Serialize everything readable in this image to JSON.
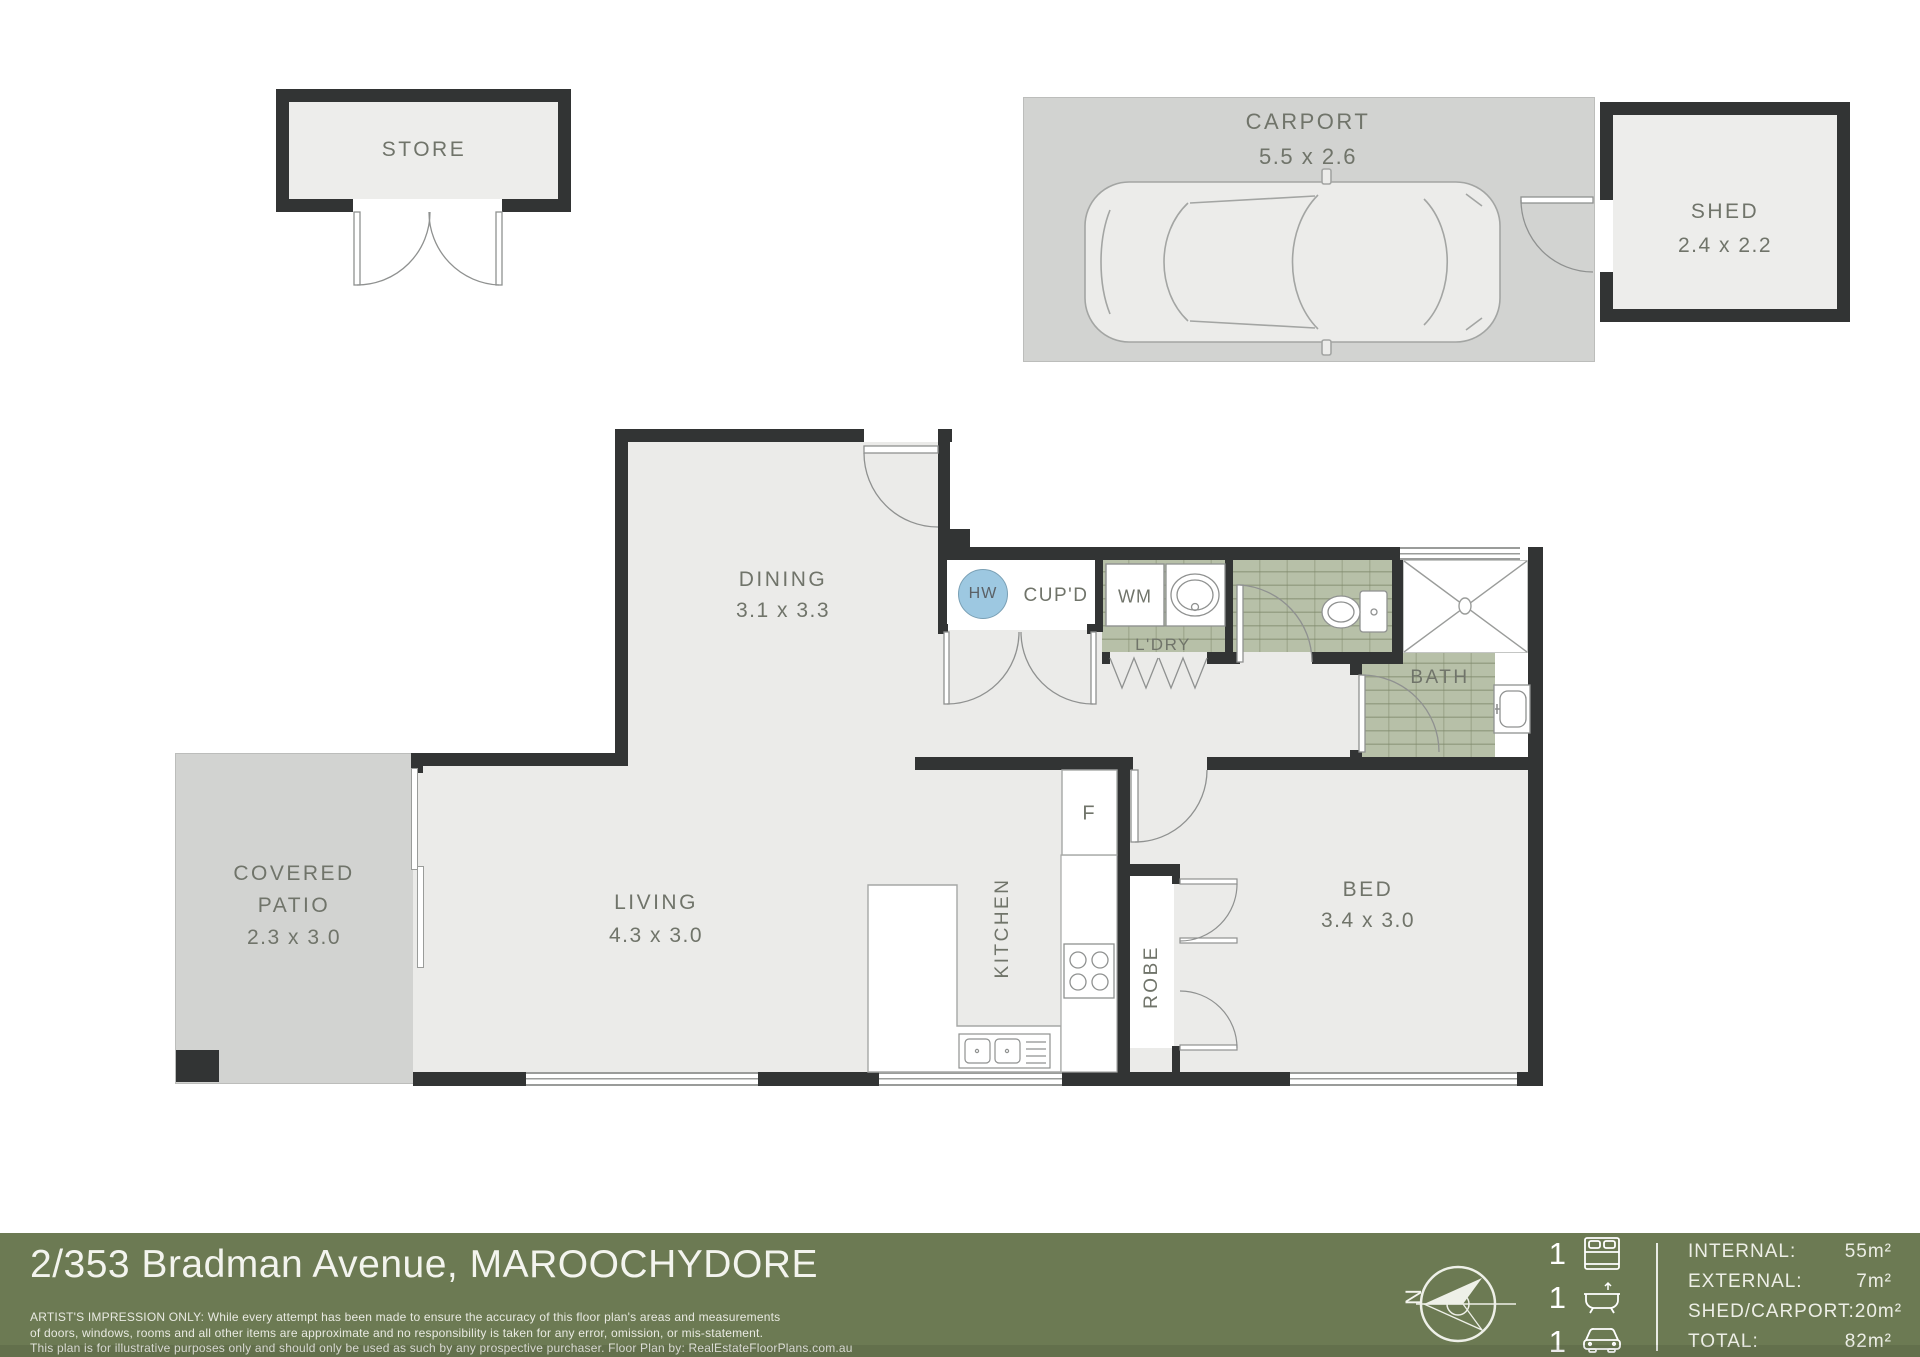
{
  "plan": {
    "store": {
      "name": "STORE"
    },
    "carport": {
      "name": "CARPORT",
      "dims": "5.5 x 2.6"
    },
    "shed": {
      "name": "SHED",
      "dims": "2.4 x 2.2"
    },
    "dining": {
      "name": "DINING",
      "dims": "3.1 x 3.3"
    },
    "living": {
      "name": "LIVING",
      "dims": "4.3 x 3.0"
    },
    "patio": {
      "line1": "COVERED",
      "line2": "PATIO",
      "dims": "2.3 x 3.0"
    },
    "bed": {
      "name": "BED",
      "dims": "3.4 x 3.0"
    },
    "bath": {
      "name": "BATH"
    },
    "kitchen": {
      "name": "KITCHEN"
    },
    "robe": {
      "name": "ROBE"
    },
    "laundry": {
      "name": "L'DRY"
    },
    "cupboard": {
      "name": "CUP'D"
    },
    "hot_water": {
      "name": "HW"
    },
    "washing_machine": {
      "name": "WM"
    },
    "fridge": {
      "name": "F"
    }
  },
  "footer": {
    "address": "2/353 Bradman Avenue, MAROOCHYDORE",
    "disclaimer_line1": "ARTIST'S IMPRESSION ONLY: While every attempt has been made to ensure the accuracy of this floor plan's areas and measurements",
    "disclaimer_line2": "of doors, windows, rooms and all other items are approximate and no responsibility is taken for any error, omission, or mis-statement.",
    "disclaimer_line3": "This plan is for illustrative purposes only and should only be used as such by any prospective purchaser. Floor Plan by: RealEstateFloorPlans.com.au",
    "compass_letter": "N",
    "counts": {
      "bed": "1",
      "bath": "1",
      "car": "1"
    },
    "stats": [
      {
        "label": "INTERNAL:",
        "value": "55m²"
      },
      {
        "label": "EXTERNAL:",
        "value": "7m²"
      },
      {
        "label": "SHED/CARPORT:",
        "value": "20m²"
      },
      {
        "label": "TOTAL:",
        "value": "82m²"
      }
    ],
    "colors": {
      "footer_green": "#6c7a53",
      "wall": "#323434",
      "tile": "#b7c0a8",
      "hw_blue": "#9dc8e1"
    }
  }
}
